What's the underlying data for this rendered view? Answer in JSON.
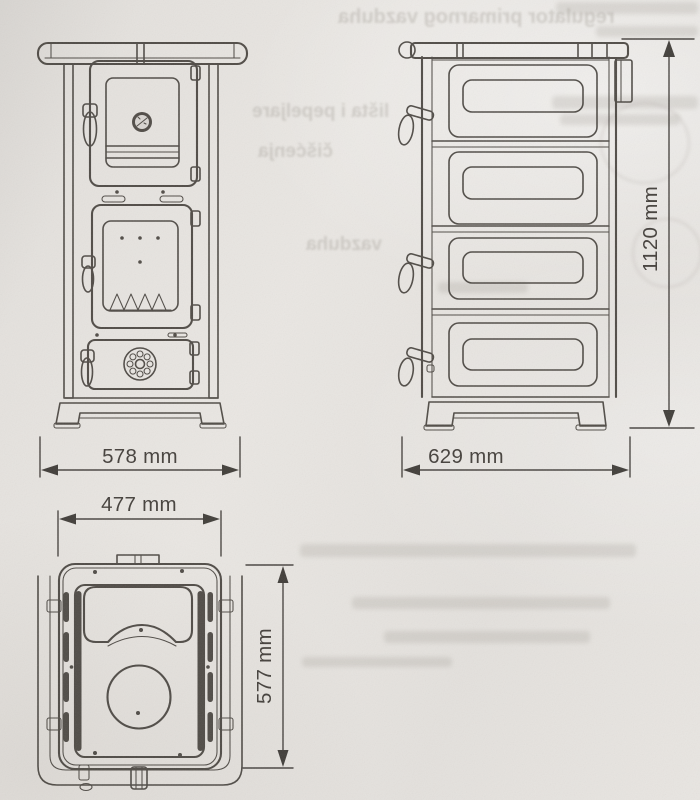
{
  "views": {
    "front": {
      "width_label": "578 mm"
    },
    "side": {
      "width_label": "629 mm",
      "height_label": "1120 mm"
    },
    "top": {
      "width_label": "477 mm",
      "depth_label": "577 mm"
    }
  },
  "ghost_text": {
    "line1": "regulator primarnog vazduha",
    "line2": "lišta i pepeljare",
    "line3": "čišćenja",
    "line4": "vazduha"
  },
  "colors": {
    "paper": "#e7e4e1",
    "ink": "#45413c",
    "dimension_text": "#383430",
    "ghost": "#9b968e"
  }
}
